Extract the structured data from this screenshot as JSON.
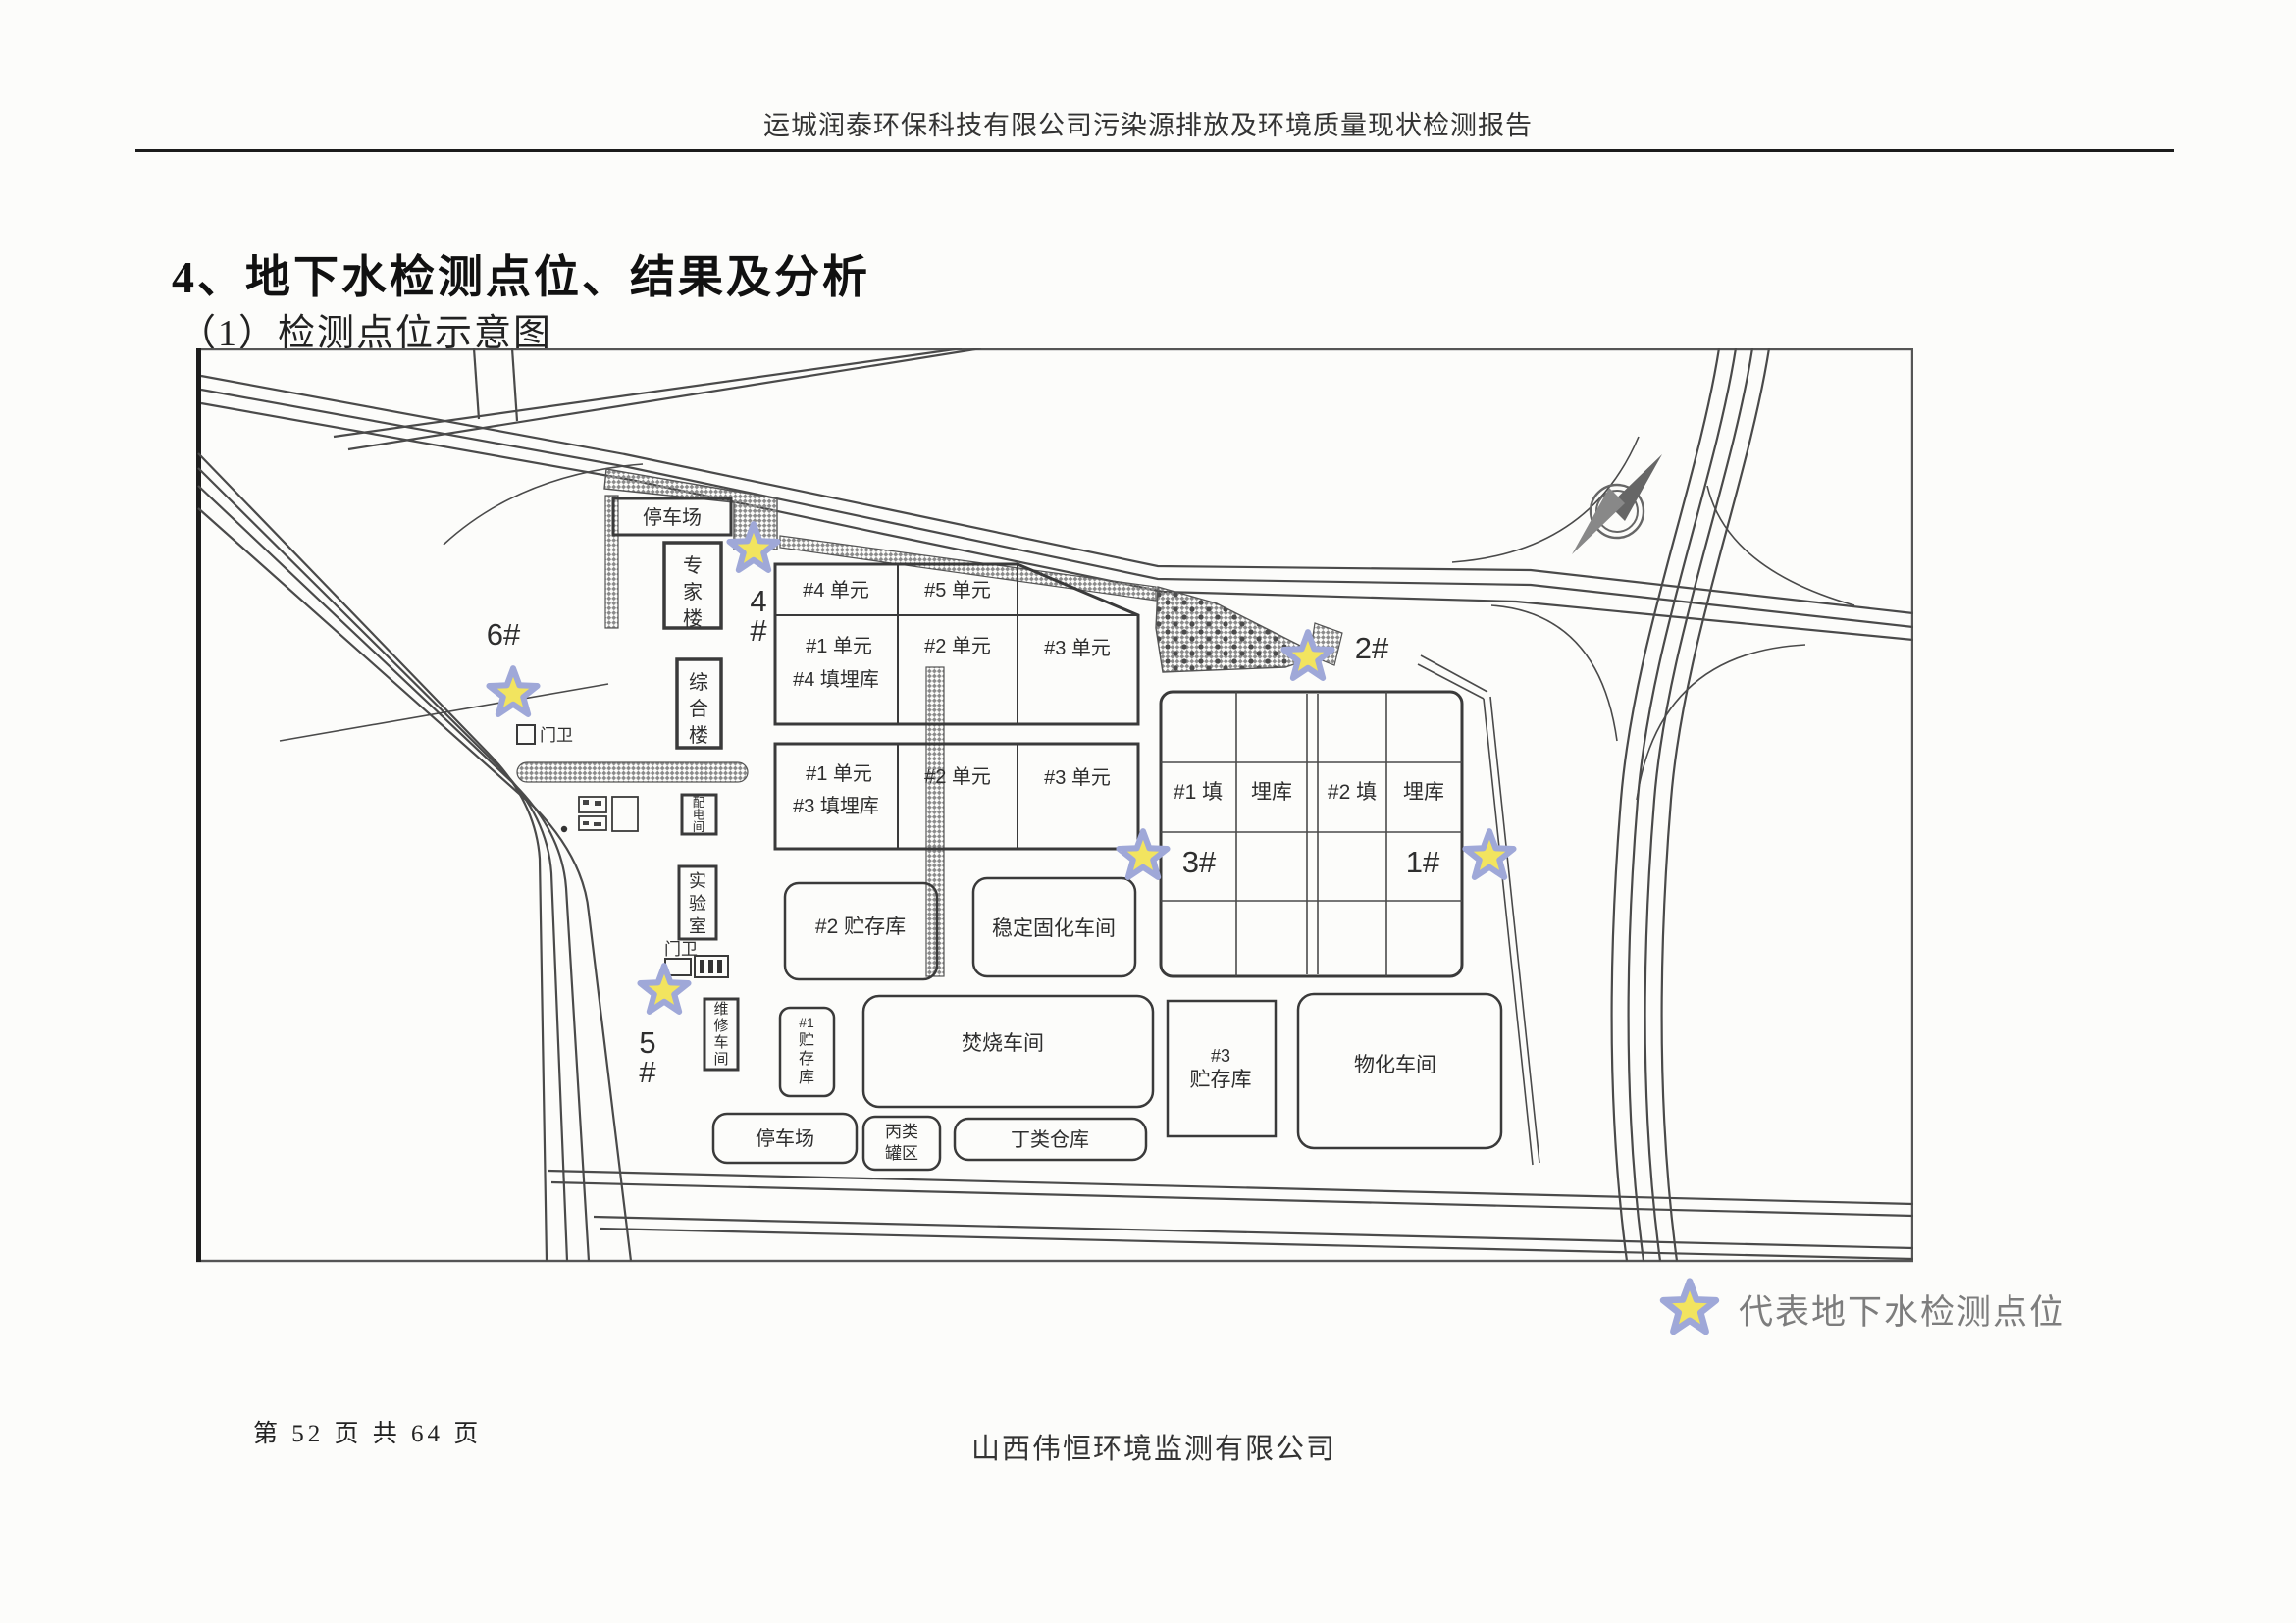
{
  "page": {
    "header_title": "运城润泰环保科技有限公司污染源排放及环境质量现状检测报告",
    "heading": "4、地下水检测点位、结果及分析",
    "subheading": "（1）检测点位示意图",
    "footer_page": "第 52 页 共 64 页",
    "footer_company": "山西伟恒环境监测有限公司"
  },
  "legend": {
    "text": "代表地下水检测点位",
    "star_fill": "#f2e45f",
    "star_stroke": "#9fa8d8"
  },
  "plan": {
    "buildings": {
      "parking_top": "停车场",
      "expert_building": "专家楼",
      "office_building": "综合楼",
      "gate_upper": "门卫",
      "power_room": "配电间",
      "laboratory": "实验室",
      "gate_lower": "门卫",
      "maintenance_shop": "维修车间",
      "storage1_num": "#1",
      "storage1_name": "贮存库",
      "storage2": "#2 贮存库",
      "stabilization_shop": "稳定固化车间",
      "incineration_shop": "焚烧车间",
      "storage3_num": "#3",
      "storage3_name": "贮存库",
      "physchem_shop": "物化车间",
      "parking_bottom": "停车场",
      "tank_area_line1": "丙类",
      "tank_area_line2": "罐区",
      "warehouse_d": "丁类仓库"
    },
    "grid_a": {
      "r1c1": "#4 单元",
      "r1c2": "#5 单元",
      "r2c1a": "#1 单元",
      "r2c1b": "#4 填埋库",
      "r2c2": "#2 单元",
      "r2c3": "#3 单元"
    },
    "grid_b": {
      "c1a": "#1 单元",
      "c1b": "#3 填埋库",
      "c2": "#2 单元",
      "c3": "#3 单元"
    },
    "grid_r": {
      "l1a": "#1 填",
      "l1b": "埋库",
      "l2a": "#2 填",
      "l2b": "埋库"
    },
    "stars": {
      "s1": {
        "label": "1#"
      },
      "s2": {
        "label": "2#"
      },
      "s3": {
        "label": "3#"
      },
      "s4": {
        "line1": "4",
        "line2": "#"
      },
      "s5": {
        "line1": "5",
        "line2": "#"
      },
      "s6": {
        "label": "6#"
      }
    },
    "colors": {
      "marker_label": "#e25560",
      "line": "#3c3c3c"
    }
  }
}
